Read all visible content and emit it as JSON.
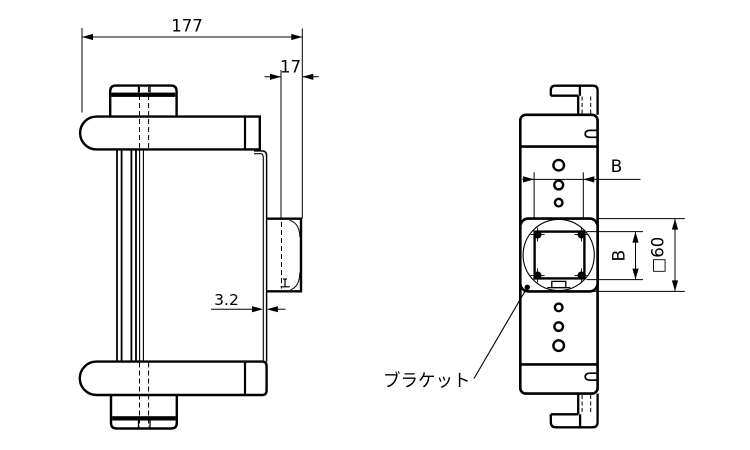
{
  "drawing": {
    "type": "engineering-drawing",
    "background": "#ffffff",
    "line_color": "#000000",
    "views": {
      "side_view": "side-view",
      "front_view": "front-view"
    },
    "dims": {
      "overall_width": "177",
      "tab_offset": "17",
      "plate_thickness": "3.2",
      "hole_pitch_h": "B",
      "hole_pitch_v": "B",
      "bracket_square": "□60"
    },
    "labels": {
      "bracket": "ブラケット"
    }
  }
}
